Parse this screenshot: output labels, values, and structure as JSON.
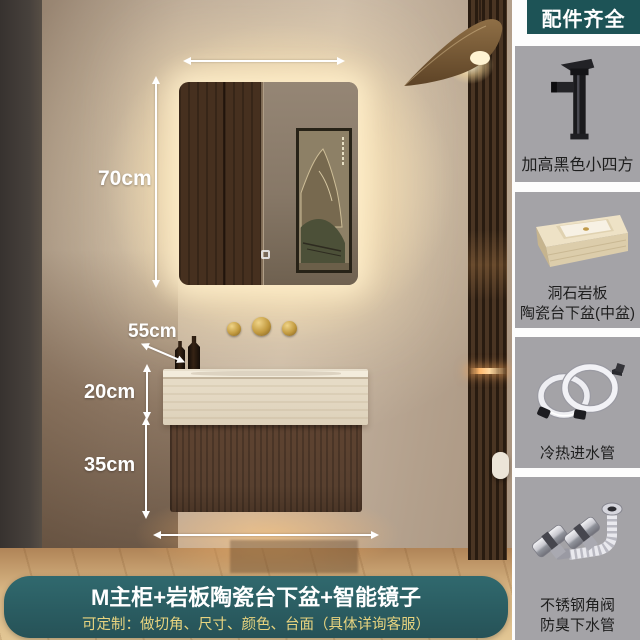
{
  "scene": {
    "annotations": {
      "mirror_height_label": "70cm",
      "counter_depth_label": "55cm",
      "counter_height_label": "20cm",
      "cabinet_height_label": "35cm"
    },
    "icons": {
      "mirror": "led-backlit-mirror",
      "painting": "landscape-painting",
      "lamp": "rattan-pendant-lamp",
      "faucet": "gold-wall-faucet"
    }
  },
  "banner": {
    "title": "M主柜+岩板陶瓷台下盆+智能镜子",
    "subtitle": "可定制：做切角、尺寸、颜色、台面（具体详询客服）"
  },
  "sidebar": {
    "header": "配件齐全",
    "items": [
      {
        "icon": "black-faucet-icon",
        "line1": "加高黑色小四方",
        "line2": ""
      },
      {
        "icon": "stone-basin-icon",
        "line1": "洞石岩板",
        "line2": "陶瓷台下盆(中盆)"
      },
      {
        "icon": "water-hoses-icon",
        "line1": "冷热进水管",
        "line2": ""
      },
      {
        "icon": "angle-valve-drain-icon",
        "line1": "不锈钢角阀",
        "line2": "防臭下水管"
      }
    ]
  },
  "colors": {
    "banner_teal": "#2b6166",
    "header_teal": "#1d5356",
    "card_gray": "#a4a3a7",
    "subtitle_gold": "#e8d47f",
    "annotation_white": "#ffffff"
  }
}
